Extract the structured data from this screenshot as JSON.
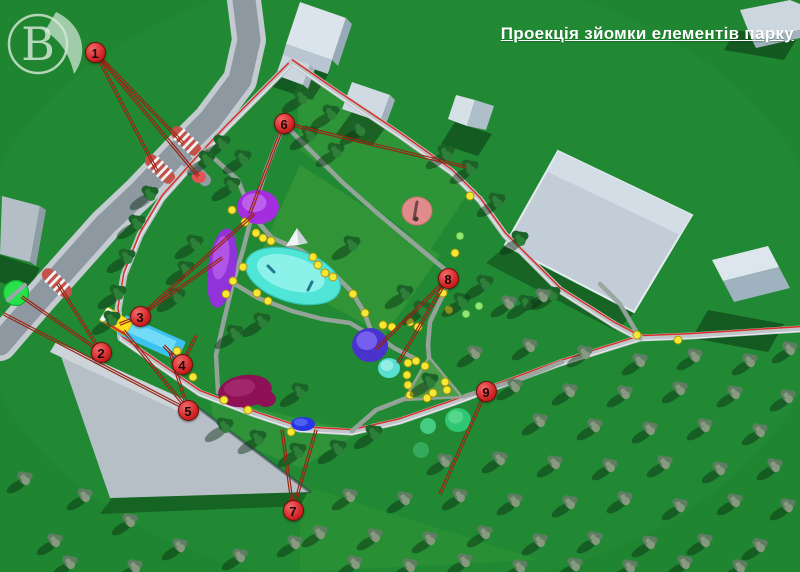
{
  "title": "Проекція зйомки елементів парку",
  "logo": {
    "letter": "B"
  },
  "colors": {
    "grass": "#1f8530",
    "road": "#8e98a1",
    "sidewalk": "#c3cbd1",
    "route_red": "#d83028",
    "pointer_red": "#992414",
    "marker_fill": "#d22626",
    "lamp_yellow": "#f6e833",
    "field_gray": "#c2cdd7",
    "parking_gray": "#b6bfc6",
    "pond_cyan": "#4fe6d8",
    "purple": "#a42ede",
    "violet_dome": "#4a33cc",
    "magenta_bed": "#8e1056",
    "stage_blue": "#2636e6",
    "glade_green": "#2fc774"
  },
  "plan": {
    "markers": [
      {
        "n": "1",
        "x": 95,
        "y": 52
      },
      {
        "n": "2",
        "x": 101,
        "y": 352
      },
      {
        "n": "3",
        "x": 140,
        "y": 316
      },
      {
        "n": "4",
        "x": 182,
        "y": 364
      },
      {
        "n": "5",
        "x": 188,
        "y": 410
      },
      {
        "n": "6",
        "x": 284,
        "y": 123
      },
      {
        "n": "7",
        "x": 293,
        "y": 510
      },
      {
        "n": "8",
        "x": 448,
        "y": 278
      },
      {
        "n": "9",
        "x": 486,
        "y": 391
      }
    ],
    "pointer_lines": [
      [
        95,
        52,
        183,
        143
      ],
      [
        95,
        52,
        157,
        171
      ],
      [
        95,
        52,
        198,
        176
      ],
      [
        101,
        352,
        22,
        297
      ],
      [
        101,
        352,
        58,
        284
      ],
      [
        140,
        316,
        120,
        324
      ],
      [
        140,
        316,
        222,
        258
      ],
      [
        140,
        316,
        254,
        214
      ],
      [
        182,
        364,
        164,
        346
      ],
      [
        182,
        364,
        196,
        336
      ],
      [
        188,
        410,
        4,
        314
      ],
      [
        188,
        410,
        124,
        331
      ],
      [
        188,
        410,
        170,
        352
      ],
      [
        284,
        123,
        250,
        213
      ],
      [
        284,
        123,
        466,
        167
      ],
      [
        293,
        510,
        282,
        430
      ],
      [
        293,
        510,
        316,
        430
      ],
      [
        448,
        278,
        376,
        349
      ],
      [
        448,
        278,
        398,
        363
      ],
      [
        486,
        391,
        440,
        494
      ]
    ],
    "lamps": [
      [
        232,
        210
      ],
      [
        245,
        222
      ],
      [
        256,
        233
      ],
      [
        263,
        238
      ],
      [
        271,
        241
      ],
      [
        313,
        257
      ],
      [
        318,
        265
      ],
      [
        325,
        273
      ],
      [
        333,
        277
      ],
      [
        353,
        294
      ],
      [
        243,
        267
      ],
      [
        233,
        281
      ],
      [
        226,
        294
      ],
      [
        257,
        293
      ],
      [
        268,
        301
      ],
      [
        365,
        313
      ],
      [
        383,
        325
      ],
      [
        392,
        327
      ],
      [
        410,
        322
      ],
      [
        418,
        327
      ],
      [
        455,
        253
      ],
      [
        443,
        293
      ],
      [
        449,
        310
      ],
      [
        224,
        400
      ],
      [
        248,
        410
      ],
      [
        291,
        432
      ],
      [
        177,
        351
      ],
      [
        193,
        377
      ],
      [
        637,
        335
      ],
      [
        678,
        340
      ],
      [
        470,
        196
      ],
      [
        408,
        363
      ],
      [
        407,
        375
      ],
      [
        408,
        385
      ],
      [
        410,
        395
      ],
      [
        427,
        398
      ],
      [
        433,
        393
      ],
      [
        445,
        382
      ],
      [
        447,
        390
      ],
      [
        425,
        366
      ],
      [
        416,
        361
      ]
    ],
    "green_lamps": [
      [
        460,
        236
      ],
      [
        479,
        306
      ],
      [
        466,
        314
      ]
    ],
    "elements": [
      {
        "name": "bus-stop-sign",
        "fill": "#e25555",
        "x": 199,
        "y": 177,
        "rx": 7,
        "ry": 6
      },
      {
        "name": "event-circle-purple",
        "fill": "#a42ede",
        "hi": "#c067ef",
        "x": 258,
        "y": 207,
        "rx": 21,
        "ry": 17
      },
      {
        "name": "flower-alley-purple",
        "fill": "#9232da",
        "hi": "#b65ce8",
        "x": 222,
        "y": 268,
        "rx": 14,
        "ry": 40,
        "rot": 8
      },
      {
        "name": "pond",
        "special": "pond",
        "fill": "#4fe6d8",
        "hi": "#97f3ec",
        "x": 293,
        "y": 276,
        "rx": 49,
        "ry": 26,
        "rot": 17
      },
      {
        "name": "pyramid",
        "special": "pyramid",
        "x": 297,
        "y": 237
      },
      {
        "name": "sculpture-circle",
        "special": "sculpture",
        "fill": "#e18c8c",
        "x": 417,
        "y": 211,
        "rx": 15,
        "ry": 14
      },
      {
        "name": "dome-blue",
        "fill": "#4a33cc",
        "hi": "#7d67f5",
        "x": 370,
        "y": 345,
        "rx": 18,
        "ry": 17
      },
      {
        "name": "round-pool",
        "fill": "#57dfd0",
        "hi": "#9ef0e8",
        "x": 389,
        "y": 368,
        "rx": 11,
        "ry": 10
      },
      {
        "name": "flowerbed-magenta",
        "fill": "#8e1056",
        "hi": "#a62a6e",
        "x": 245,
        "y": 391,
        "rx": 27,
        "ry": 16,
        "rot": -8
      },
      {
        "name": "flowerbed-magenta-lobe",
        "fill": "#8e1056",
        "x": 266,
        "y": 399,
        "rx": 10,
        "ry": 8
      },
      {
        "name": "stage-blue",
        "fill": "#2636e6",
        "hi": "#5466f2",
        "x": 303,
        "y": 424,
        "rx": 12,
        "ry": 7
      },
      {
        "name": "green-glade-1",
        "fill": "#2fc774",
        "hi": "#5ad892",
        "x": 458,
        "y": 420,
        "rx": 13,
        "ry": 12
      },
      {
        "name": "green-glade-2",
        "fill": "#44cc82",
        "x": 428,
        "y": 426,
        "rx": 8,
        "ry": 8
      },
      {
        "name": "green-glade-3",
        "fill": "#3fbf78",
        "op": 0.6,
        "x": 421,
        "y": 450,
        "rx": 8,
        "ry": 8
      },
      {
        "name": "bench-sign",
        "special": "bench",
        "x": 16,
        "y": 293
      },
      {
        "name": "waterslide",
        "special": "slide",
        "x": 117,
        "y": 322
      },
      {
        "name": "triangle-plaza",
        "special": "plaza"
      }
    ]
  }
}
